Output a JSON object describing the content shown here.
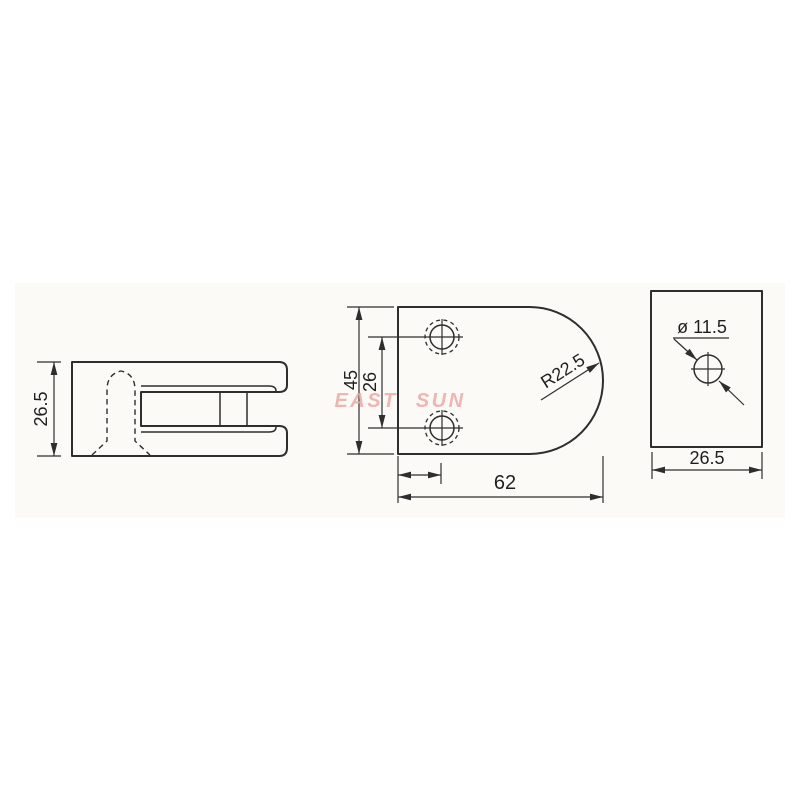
{
  "watermark": "EAST SUN",
  "colors": {
    "line": "#2e2e2e",
    "watermark": "#eda6a3",
    "panel": "#fbfaf6",
    "background": "#ffffff"
  },
  "side_view": {
    "height": "26.5"
  },
  "front_view": {
    "overall_height": "45",
    "hole_spacing": "26",
    "overall_width": "62",
    "corner_radius": "R22.5"
  },
  "end_view": {
    "hole_diameter": "ø 11.5",
    "width": "26.5"
  }
}
